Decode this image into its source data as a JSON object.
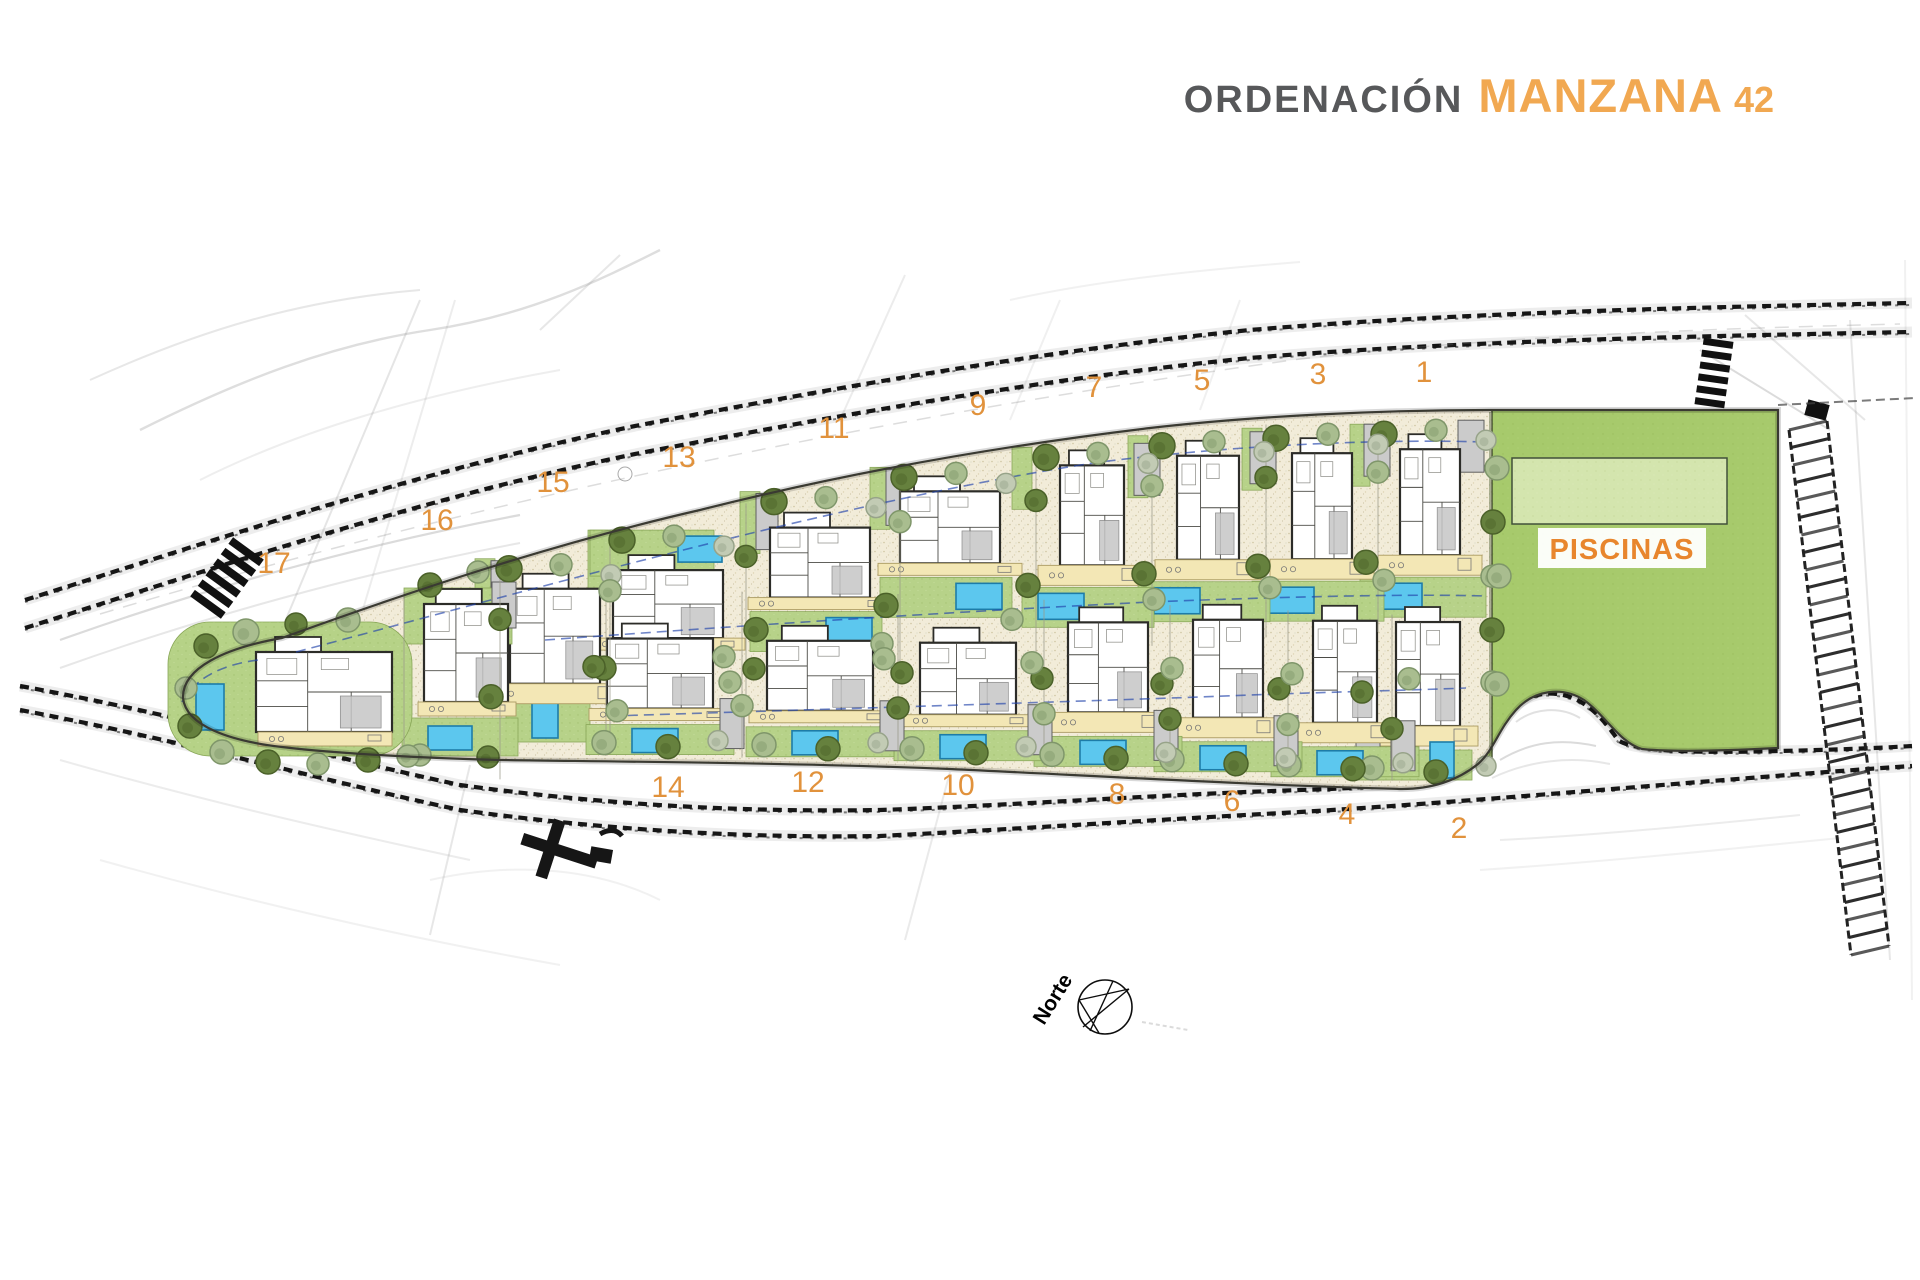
{
  "title": {
    "section": "ORDENACIÓN",
    "block_name": "MANZANA",
    "block_number": "42"
  },
  "labels": {
    "pools": "PISCINAS",
    "north": "Norte"
  },
  "colors": {
    "accent_orange": "#e1923c",
    "title_grey": "#57585a",
    "title_orange": "#f1a851",
    "piscinas_orange": "#e8862d",
    "sand": "#f2ecd9",
    "lawn_green": "#b6d287",
    "piscinas_green": "#a7ca6c",
    "pool_pad_green": "#d4e5ae",
    "pool_water_blue": "#5cc7ee",
    "road_ink": "#161616",
    "setback_blue": "#2244aa"
  },
  "plots": [
    {
      "number": "1",
      "row": "top",
      "label_x": 1424,
      "label_y": 382
    },
    {
      "number": "3",
      "row": "top",
      "label_x": 1318,
      "label_y": 384
    },
    {
      "number": "5",
      "row": "top",
      "label_x": 1202,
      "label_y": 390
    },
    {
      "number": "7",
      "row": "top",
      "label_x": 1094,
      "label_y": 397
    },
    {
      "number": "9",
      "row": "top",
      "label_x": 978,
      "label_y": 415
    },
    {
      "number": "11",
      "row": "top",
      "label_x": 834,
      "label_y": 438
    },
    {
      "number": "13",
      "row": "top",
      "label_x": 679,
      "label_y": 467
    },
    {
      "number": "15",
      "row": "top",
      "label_x": 553,
      "label_y": 492
    },
    {
      "number": "16",
      "row": "tall",
      "label_x": 437,
      "label_y": 530
    },
    {
      "number": "17",
      "row": "tip",
      "label_x": 274,
      "label_y": 573
    },
    {
      "number": "2",
      "row": "bottom",
      "label_x": 1459,
      "label_y": 838
    },
    {
      "number": "4",
      "row": "bottom",
      "label_x": 1347,
      "label_y": 824
    },
    {
      "number": "6",
      "row": "bottom",
      "label_x": 1232,
      "label_y": 811
    },
    {
      "number": "8",
      "row": "bottom",
      "label_x": 1117,
      "label_y": 804
    },
    {
      "number": "10",
      "row": "bottom",
      "label_x": 958,
      "label_y": 795
    },
    {
      "number": "12",
      "row": "bottom",
      "label_x": 808,
      "label_y": 792
    },
    {
      "number": "14",
      "row": "bottom",
      "label_x": 668,
      "label_y": 797
    }
  ]
}
